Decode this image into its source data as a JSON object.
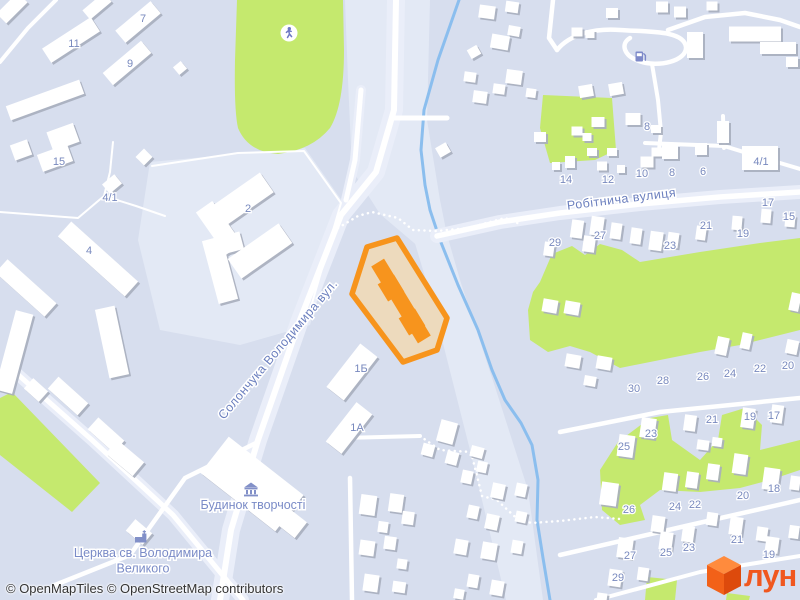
{
  "attribution": "© OpenMapTiles © OpenStreetMap contributors",
  "logo": {
    "text": "лун",
    "color": "#F0571F",
    "cube_top": "#FF8B3D",
    "cube_left": "#F26118",
    "cube_right": "#DD4A0C"
  },
  "map": {
    "colors": {
      "bg": "#D7DEEE",
      "zone": "#E3E9F5",
      "casing": "#EAEEF9",
      "road": "#FFFFFF",
      "green": "#C5E96E",
      "stream": "#8BBEEE",
      "building": "#FFFFFF",
      "shadow": "#A8ADBD",
      "num_label": "#7889BE",
      "street_label": "#6B7FBE",
      "poi_label": "#7A8BC7",
      "poi_icon": "#8290C8",
      "runner_icon": "#6E79C4",
      "fuel_icon": "#7D89C9"
    },
    "light_zones": [
      "345,0 430,0 427,120 440,200 452,260 420,248 380,214 352,170 348,80",
      "440,210 460,280 496,390 528,490 543,600 506,600 470,450 432,300 414,240",
      "150,162 305,148 345,205 310,325 240,345 160,330 138,240"
    ],
    "greens": [
      {
        "d": "M 237,0 L 343,0 L 344,50 Q 344,105 330,128 Q 312,150 278,154 Q 248,152 238,128 Q 234,110 235,60 Z"
      },
      {
        "pts": "543,95 612,98 616,150 595,160 550,163 540,128"
      },
      {
        "pts": "540,282 552,254 572,246 585,255 600,244 622,250 640,262 700,252 760,243 800,238 800,330 740,345 700,352 660,360 620,368 590,352 570,346 548,352 530,340 528,310 533,292"
      },
      {
        "pts": "600,470 618,442 650,418 668,415 672,440 700,460 718,440 722,415 745,408 762,425 760,450 800,440 800,470 770,480 740,488 700,492 660,490 640,505 645,520 620,525 602,510"
      },
      {
        "pts": "0,398 12,392 100,483 72,512 0,455"
      },
      {
        "pts": "647,577 677,580 675,600 645,600"
      },
      {
        "pts": "727,593 750,596 749,600 726,600"
      }
    ],
    "streams": [
      "459,0 438,60 424,110 421,150 425,185 430,210 440,240 458,285 478,330 492,370 505,400 521,423 532,445 538,480 537,520 543,558 550,600"
    ],
    "roads": [
      {
        "p": "396,0 394,110 376,172 341,215 300,320 258,440 231,530 220,600",
        "w": 6,
        "c": 18
      },
      {
        "p": "361,90 355,160 346,200",
        "w": 5,
        "c": 10
      },
      {
        "p": "394,118 447,118",
        "w": 5
      },
      {
        "p": "437,236 500,222 560,213 640,204 720,197 800,192",
        "w": 5.5,
        "c": 14
      },
      {
        "p": "645,143 724,146",
        "w": 4
      },
      {
        "p": "723,116 724,148",
        "w": 4
      },
      {
        "p": "724,146 770,160 800,169",
        "w": 4
      },
      {
        "p": "553,0 549,38 557,50",
        "w": 4.5
      },
      {
        "d": "M 557,50 C 570,34 595,28 620,30 C 648,32 684,30 686,47 C 687,61 658,68 639,61 C 624,56 620,44 630,38",
        "w": 4.5
      },
      {
        "p": "668,30 705,17 745,13 780,20 800,27",
        "w": 4.5
      },
      {
        "p": "652,64 658,100 661,132 659,150",
        "w": 4
      },
      {
        "p": "0,62 28,28 56,0",
        "w": 4
      },
      {
        "p": "15,372 92,440 173,515 243,600",
        "w": 5,
        "c": 12
      },
      {
        "p": "55,585 130,555 185,478 258,442",
        "w": 4.5
      },
      {
        "p": "350,478 352,600",
        "w": 4.5
      },
      {
        "p": "342,438 420,436",
        "w": 4
      },
      {
        "p": "560,432 660,412 800,398",
        "w": 4.5
      },
      {
        "p": "560,555 690,525 800,500",
        "w": 4.5
      },
      {
        "p": "596,600 700,572 800,556",
        "w": 4
      }
    ],
    "thin_paths": [
      "0,212 78,218 104,196 110,172 113,142",
      "104,196 136,206 165,216",
      "152,166 238,153 304,151 341,203 306,324"
    ],
    "dotted_paths": [
      "338,228 358,216 372,212 398,218 413,230 437,231 468,228 505,218 520,224",
      "420,436 440,450 471,452 482,496 497,500 514,516 531,523 560,521 595,517 620,519"
    ],
    "buildings": [
      [
        71,
        40,
        58,
        17,
        -33
      ],
      [
        138,
        22,
        46,
        16,
        -40
      ],
      [
        127,
        63,
        50,
        16,
        -40
      ],
      [
        97,
        6,
        28,
        12,
        -40
      ],
      [
        12,
        8,
        30,
        14,
        -45
      ],
      [
        45,
        100,
        78,
        15,
        -20
      ],
      [
        63,
        137,
        28,
        20,
        -20
      ],
      [
        55,
        158,
        32,
        18,
        -20
      ],
      [
        21,
        150,
        18,
        16,
        -20
      ],
      [
        112,
        184,
        16,
        12,
        -40
      ],
      [
        180,
        68,
        10,
        10,
        -40
      ],
      [
        144,
        157,
        12,
        12,
        45
      ],
      [
        243,
        199,
        58,
        24,
        -35
      ],
      [
        219,
        228,
        52,
        20,
        55
      ],
      [
        260,
        251,
        62,
        24,
        -35
      ],
      [
        98,
        259,
        90,
        20,
        42
      ],
      [
        26,
        288,
        66,
        18,
        42
      ],
      [
        14,
        352,
        18,
        82,
        15
      ],
      [
        112,
        342,
        20,
        70,
        -12
      ],
      [
        220,
        270,
        20,
        65,
        -15
      ],
      [
        231,
        243,
        22,
        18,
        -15
      ],
      [
        68,
        396,
        40,
        16,
        42
      ],
      [
        36,
        390,
        20,
        14,
        42
      ],
      [
        106,
        435,
        35,
        16,
        42
      ],
      [
        352,
        372,
        55,
        22,
        -52
      ],
      [
        349,
        428,
        50,
        20,
        -52
      ],
      [
        252,
        484,
        95,
        46,
        38
      ],
      [
        289,
        521,
        30,
        20,
        38
      ],
      [
        125,
        458,
        35,
        18,
        40
      ],
      [
        139,
        532,
        22,
        15,
        40
      ],
      [
        487,
        12,
        16,
        13,
        8
      ],
      [
        512,
        7,
        13,
        11,
        8
      ],
      [
        662,
        7,
        12,
        11,
        0
      ],
      [
        680,
        12,
        12,
        11,
        0
      ],
      [
        712,
        6,
        11,
        9,
        0
      ],
      [
        500,
        42,
        18,
        14,
        10
      ],
      [
        514,
        31,
        12,
        10,
        10
      ],
      [
        474,
        52,
        11,
        10,
        -30
      ],
      [
        470,
        77,
        12,
        10,
        8
      ],
      [
        514,
        77,
        16,
        14,
        8
      ],
      [
        480,
        97,
        14,
        12,
        8
      ],
      [
        499,
        89,
        12,
        10,
        8
      ],
      [
        531,
        93,
        10,
        9,
        8
      ],
      [
        577,
        32,
        11,
        9,
        0
      ],
      [
        590,
        34,
        9,
        8,
        0
      ],
      [
        612,
        13,
        12,
        10,
        0
      ],
      [
        586,
        91,
        14,
        12,
        -10
      ],
      [
        616,
        89,
        14,
        12,
        -10
      ],
      [
        695,
        45,
        16,
        26,
        0
      ],
      [
        755,
        34,
        52,
        15,
        0
      ],
      [
        778,
        48,
        36,
        12,
        0
      ],
      [
        792,
        62,
        12,
        10,
        0
      ],
      [
        540,
        137,
        12,
        10,
        0
      ],
      [
        577,
        131,
        11,
        9,
        0
      ],
      [
        598,
        122,
        13,
        10,
        0
      ],
      [
        633,
        119,
        15,
        12,
        0
      ],
      [
        656,
        129,
        10,
        8,
        0
      ],
      [
        647,
        162,
        13,
        11,
        0
      ],
      [
        612,
        152,
        10,
        8,
        0
      ],
      [
        587,
        137,
        9,
        8,
        0
      ],
      [
        592,
        152,
        10,
        8,
        0
      ],
      [
        570,
        162,
        10,
        12,
        0
      ],
      [
        556,
        166,
        8,
        8,
        0
      ],
      [
        602,
        166,
        10,
        9,
        0
      ],
      [
        621,
        169,
        8,
        8,
        0
      ],
      [
        670,
        152,
        16,
        14,
        0
      ],
      [
        701,
        149,
        12,
        12,
        0
      ],
      [
        657,
        152,
        11,
        9,
        0
      ],
      [
        723,
        132,
        12,
        22,
        0
      ],
      [
        760,
        158,
        36,
        24,
        0
      ],
      [
        577,
        229,
        12,
        18,
        8
      ],
      [
        597,
        226,
        13,
        19,
        8
      ],
      [
        616,
        231,
        11,
        16,
        8
      ],
      [
        636,
        236,
        11,
        16,
        8
      ],
      [
        656,
        241,
        13,
        19,
        8
      ],
      [
        673,
        240,
        11,
        15,
        8
      ],
      [
        701,
        233,
        10,
        14,
        8
      ],
      [
        737,
        223,
        10,
        14,
        5
      ],
      [
        766,
        216,
        10,
        14,
        5
      ],
      [
        790,
        221,
        10,
        12,
        5
      ],
      [
        549,
        249,
        10,
        14,
        8
      ],
      [
        589,
        244,
        12,
        16,
        8
      ],
      [
        550,
        306,
        15,
        13,
        10
      ],
      [
        572,
        308,
        15,
        13,
        10
      ],
      [
        573,
        361,
        15,
        13,
        10
      ],
      [
        604,
        363,
        15,
        13,
        10
      ],
      [
        590,
        381,
        12,
        10,
        10
      ],
      [
        722,
        346,
        12,
        18,
        12
      ],
      [
        746,
        341,
        10,
        16,
        12
      ],
      [
        792,
        347,
        12,
        14,
        12
      ],
      [
        795,
        302,
        10,
        18,
        12
      ],
      [
        443,
        150,
        12,
        11,
        -30
      ],
      [
        626,
        446,
        16,
        22,
        8
      ],
      [
        648,
        428,
        15,
        20,
        8
      ],
      [
        690,
        423,
        12,
        16,
        8
      ],
      [
        748,
        418,
        13,
        20,
        8
      ],
      [
        777,
        414,
        12,
        18,
        8
      ],
      [
        703,
        445,
        12,
        10,
        8
      ],
      [
        717,
        442,
        10,
        9,
        8
      ],
      [
        609,
        494,
        17,
        23,
        8
      ],
      [
        670,
        482,
        14,
        18,
        8
      ],
      [
        692,
        480,
        12,
        16,
        8
      ],
      [
        713,
        472,
        12,
        16,
        8
      ],
      [
        740,
        464,
        14,
        20,
        8
      ],
      [
        771,
        479,
        16,
        22,
        8
      ],
      [
        795,
        483,
        10,
        14,
        8
      ],
      [
        625,
        548,
        15,
        20,
        8
      ],
      [
        658,
        524,
        13,
        16,
        8
      ],
      [
        666,
        541,
        13,
        18,
        8
      ],
      [
        688,
        534,
        12,
        16,
        8
      ],
      [
        712,
        519,
        11,
        13,
        8
      ],
      [
        736,
        526,
        13,
        18,
        8
      ],
      [
        762,
        534,
        11,
        14,
        8
      ],
      [
        772,
        545,
        13,
        16,
        8
      ],
      [
        794,
        532,
        10,
        13,
        8
      ],
      [
        615,
        578,
        13,
        17,
        8
      ],
      [
        643,
        574,
        11,
        13,
        8
      ],
      [
        602,
        597,
        10,
        8,
        8
      ],
      [
        368,
        505,
        16,
        20,
        8
      ],
      [
        396,
        503,
        14,
        18,
        8
      ],
      [
        408,
        518,
        12,
        13,
        8
      ],
      [
        383,
        527,
        10,
        11,
        8
      ],
      [
        390,
        543,
        12,
        13,
        8
      ],
      [
        367,
        548,
        15,
        15,
        8
      ],
      [
        402,
        564,
        10,
        10,
        8
      ],
      [
        371,
        583,
        15,
        17,
        8
      ],
      [
        399,
        587,
        13,
        11,
        8
      ],
      [
        447,
        432,
        17,
        22,
        15
      ],
      [
        428,
        450,
        12,
        12,
        15
      ],
      [
        452,
        458,
        12,
        13,
        15
      ],
      [
        477,
        452,
        13,
        11,
        15
      ],
      [
        467,
        477,
        11,
        13,
        12
      ],
      [
        482,
        467,
        10,
        11,
        12
      ],
      [
        498,
        491,
        13,
        15,
        12
      ],
      [
        521,
        490,
        11,
        13,
        12
      ],
      [
        473,
        512,
        11,
        13,
        12
      ],
      [
        492,
        522,
        13,
        15,
        12
      ],
      [
        521,
        517,
        11,
        11,
        12
      ],
      [
        461,
        547,
        13,
        15,
        10
      ],
      [
        489,
        551,
        15,
        17,
        10
      ],
      [
        517,
        547,
        11,
        13,
        10
      ],
      [
        473,
        581,
        11,
        13,
        10
      ],
      [
        497,
        588,
        13,
        15,
        10
      ],
      [
        459,
        594,
        10,
        10,
        10
      ]
    ],
    "highlight": {
      "ring_pts": "397,238 447,318 437,350 403,362 352,294 367,247",
      "fill": "#EDDABD",
      "stroke": "#F7941C",
      "stroke_width": 5.5,
      "building_color": "#F7941D",
      "bars": [
        [
          401,
          301,
          90,
          15,
          58.7
        ],
        [
          391,
          288,
          20,
          19,
          58.7
        ],
        [
          412,
          322,
          20,
          19,
          58.7
        ]
      ]
    },
    "street_labels": [
      {
        "t": "Солончука Володимира вул.",
        "x": 281,
        "y": 352,
        "r": -50
      },
      {
        "t": "Робітнича вулиця",
        "x": 622,
        "y": 203,
        "r": -7
      }
    ],
    "poi_labels": [
      {
        "lines": [
          "Будинок творчості"
        ],
        "x": 253,
        "y": 509,
        "icon": "museum",
        "ix": 251,
        "iy": 489
      },
      {
        "lines": [
          "Церква св. Володимира",
          "Великого"
        ],
        "x": 143,
        "y": 557,
        "icon": "church",
        "ix": 141,
        "iy": 537
      }
    ],
    "icons": {
      "runner": {
        "x": 289,
        "y": 33
      },
      "fuel": {
        "x": 640,
        "y": 57
      }
    },
    "number_labels": [
      {
        "t": "11",
        "x": 74,
        "y": 43
      },
      {
        "t": "7",
        "x": 143,
        "y": 18
      },
      {
        "t": "9",
        "x": 130,
        "y": 63
      },
      {
        "t": "15",
        "x": 59,
        "y": 161
      },
      {
        "t": "4/1",
        "x": 110,
        "y": 197
      },
      {
        "t": "2",
        "x": 248,
        "y": 208
      },
      {
        "t": "4",
        "x": 89,
        "y": 250
      },
      {
        "t": "1Б",
        "x": 361,
        "y": 368
      },
      {
        "t": "1А",
        "x": 357,
        "y": 427
      },
      {
        "t": "8",
        "x": 647,
        "y": 126
      },
      {
        "t": "14",
        "x": 566,
        "y": 179
      },
      {
        "t": "12",
        "x": 608,
        "y": 179
      },
      {
        "t": "10",
        "x": 642,
        "y": 173
      },
      {
        "t": "8",
        "x": 672,
        "y": 172
      },
      {
        "t": "6",
        "x": 703,
        "y": 171
      },
      {
        "t": "4/1",
        "x": 761,
        "y": 161
      },
      {
        "t": "17",
        "x": 768,
        "y": 202
      },
      {
        "t": "15",
        "x": 789,
        "y": 216
      },
      {
        "t": "29",
        "x": 555,
        "y": 242
      },
      {
        "t": "27",
        "x": 600,
        "y": 235
      },
      {
        "t": "23",
        "x": 670,
        "y": 245
      },
      {
        "t": "21",
        "x": 706,
        "y": 225
      },
      {
        "t": "19",
        "x": 743,
        "y": 233
      },
      {
        "t": "30",
        "x": 634,
        "y": 388
      },
      {
        "t": "28",
        "x": 663,
        "y": 380
      },
      {
        "t": "26",
        "x": 703,
        "y": 376
      },
      {
        "t": "24",
        "x": 730,
        "y": 373
      },
      {
        "t": "22",
        "x": 760,
        "y": 368
      },
      {
        "t": "20",
        "x": 788,
        "y": 365
      },
      {
        "t": "25",
        "x": 624,
        "y": 446
      },
      {
        "t": "23",
        "x": 651,
        "y": 433
      },
      {
        "t": "21",
        "x": 712,
        "y": 419
      },
      {
        "t": "19",
        "x": 750,
        "y": 416
      },
      {
        "t": "17",
        "x": 774,
        "y": 415
      },
      {
        "t": "26",
        "x": 629,
        "y": 509
      },
      {
        "t": "24",
        "x": 675,
        "y": 506
      },
      {
        "t": "22",
        "x": 695,
        "y": 504
      },
      {
        "t": "20",
        "x": 743,
        "y": 495
      },
      {
        "t": "18",
        "x": 774,
        "y": 488
      },
      {
        "t": "29",
        "x": 618,
        "y": 577
      },
      {
        "t": "27",
        "x": 630,
        "y": 555
      },
      {
        "t": "25",
        "x": 666,
        "y": 552
      },
      {
        "t": "23",
        "x": 689,
        "y": 547
      },
      {
        "t": "21",
        "x": 737,
        "y": 539
      },
      {
        "t": "19",
        "x": 769,
        "y": 554
      }
    ]
  }
}
